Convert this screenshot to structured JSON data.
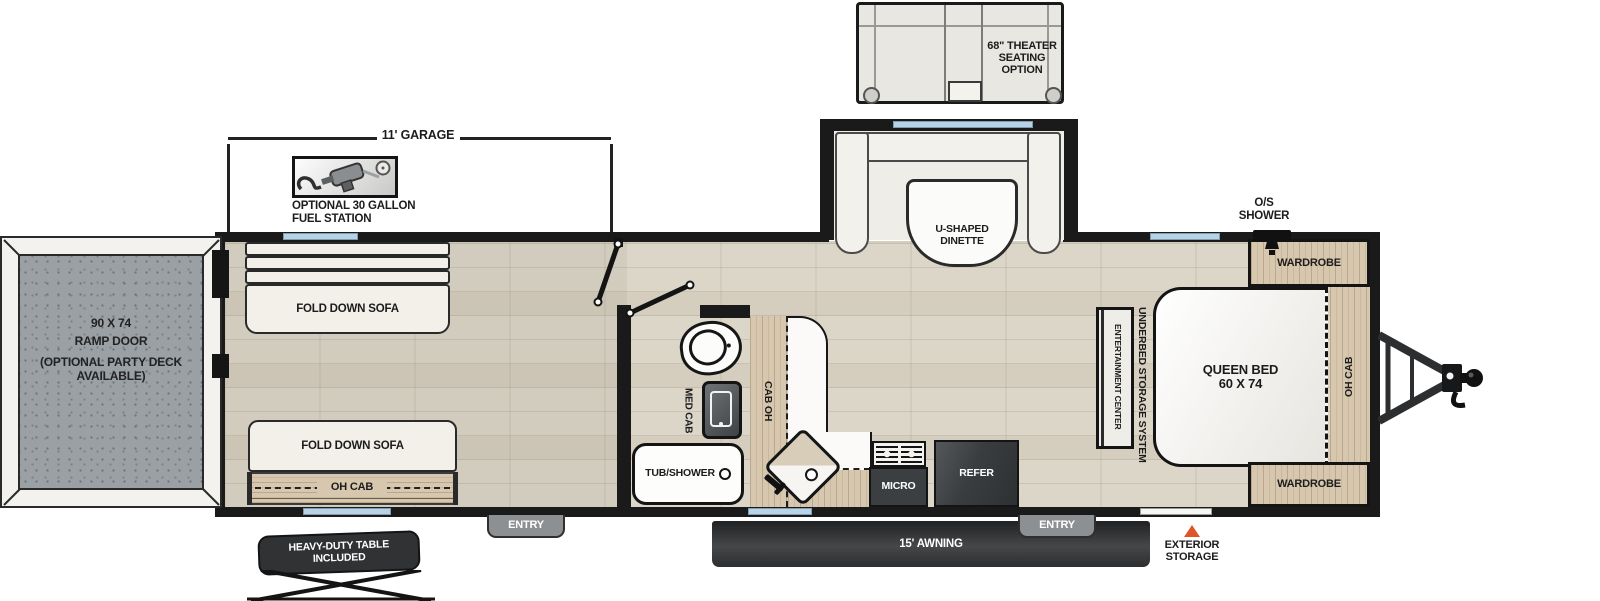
{
  "labels": {
    "theater_seating": "68\" THEATER SEATING OPTION",
    "garage_dimension": "11' GARAGE",
    "fuel_station_line1": "OPTIONAL 30 GALLON",
    "fuel_station_line2": "FUEL STATION",
    "dinette": "U-SHAPED DINETTE",
    "os_shower_line1": "O/S",
    "os_shower_line2": "SHOWER",
    "ramp_size": "90 X 74",
    "ramp_name": "RAMP DOOR",
    "ramp_note1": "(OPTIONAL PARTY DECK",
    "ramp_note2": "AVAILABLE)",
    "fold_down_sofa": "FOLD DOWN SOFA",
    "oh_cab": "OH CAB",
    "cab_oh": "CAB OH",
    "med_cab": "MED CAB",
    "tub_shower": "TUB/SHOWER",
    "micro": "MICRO",
    "refer": "REFER",
    "entertainment_center": "ENTERTAINMENT CENTER",
    "underbed_storage": "UNDERBED STORAGE SYSTEM",
    "queen_bed_line1": "QUEEN BED",
    "queen_bed_line2": "60 X 74",
    "wardrobe": "WARDROBE",
    "entry": "ENTRY",
    "awning": "15' AWNING",
    "exterior_storage_line1": "EXTERIOR",
    "exterior_storage_line2": "STORAGE",
    "table_line1": "HEAVY-DUTY TABLE",
    "table_line2": "INCLUDED"
  },
  "colors": {
    "wall": "#1a1a1a",
    "wood": "#d6c7ae",
    "window_blue": "#b9d3e6",
    "awning_dark": "#2d2f31",
    "exterior_storage_marker": "#e0542a",
    "appliance_dark": "#3c3f41",
    "ramp_gray": "#9aa0a4"
  }
}
